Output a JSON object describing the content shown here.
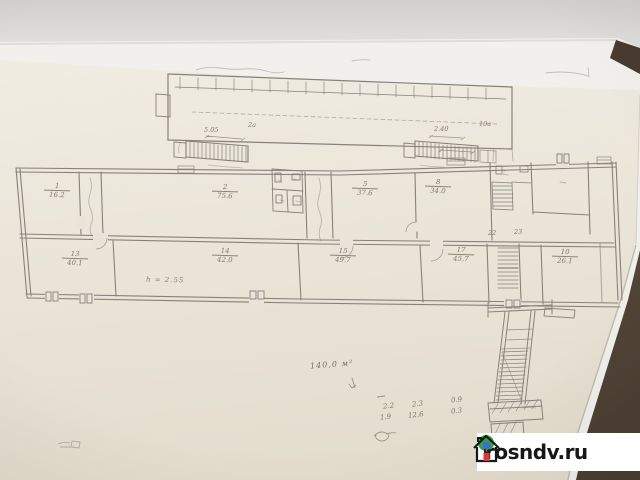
{
  "colors": {
    "table": "#6b5848",
    "backdrop": "#d8d6d3",
    "back_sheet": "#f2f0ec",
    "paper": "#eae4d8",
    "pencil": "#87817a",
    "watermark_bg": "#ffffff",
    "watermark_text": "#171717",
    "tree_green": "#35a13c",
    "door_red": "#e0392e",
    "window_blue": "#3c6fd1"
  },
  "watermark": {
    "site": "rosndv.ru"
  },
  "plan": {
    "rooms": [
      {
        "num": "1",
        "area": "16.2"
      },
      {
        "num": "2",
        "area": "75.6"
      },
      {
        "num": "5",
        "area": "37.6"
      },
      {
        "num": "8",
        "area": "34.0"
      },
      {
        "num": "13",
        "area": "40.1"
      },
      {
        "num": "14",
        "area": "42.0"
      },
      {
        "num": "15",
        "area": "49.7"
      },
      {
        "num": "17",
        "area": "45.7"
      },
      {
        "num": "10",
        "area": "26.1"
      }
    ],
    "small_rooms": [
      "22",
      "23"
    ],
    "stair_left": {
      "dim": "5.05",
      "label": "2a"
    },
    "stair_right": {
      "dim": "2.40",
      "label": "10a"
    },
    "height_note": "h = 2.55",
    "annotations": {
      "total": "140,0 м²",
      "rows": [
        [
          "2.2",
          "2.3",
          "0.9"
        ],
        [
          "1.9",
          "12.6",
          "0.3"
        ]
      ]
    }
  }
}
